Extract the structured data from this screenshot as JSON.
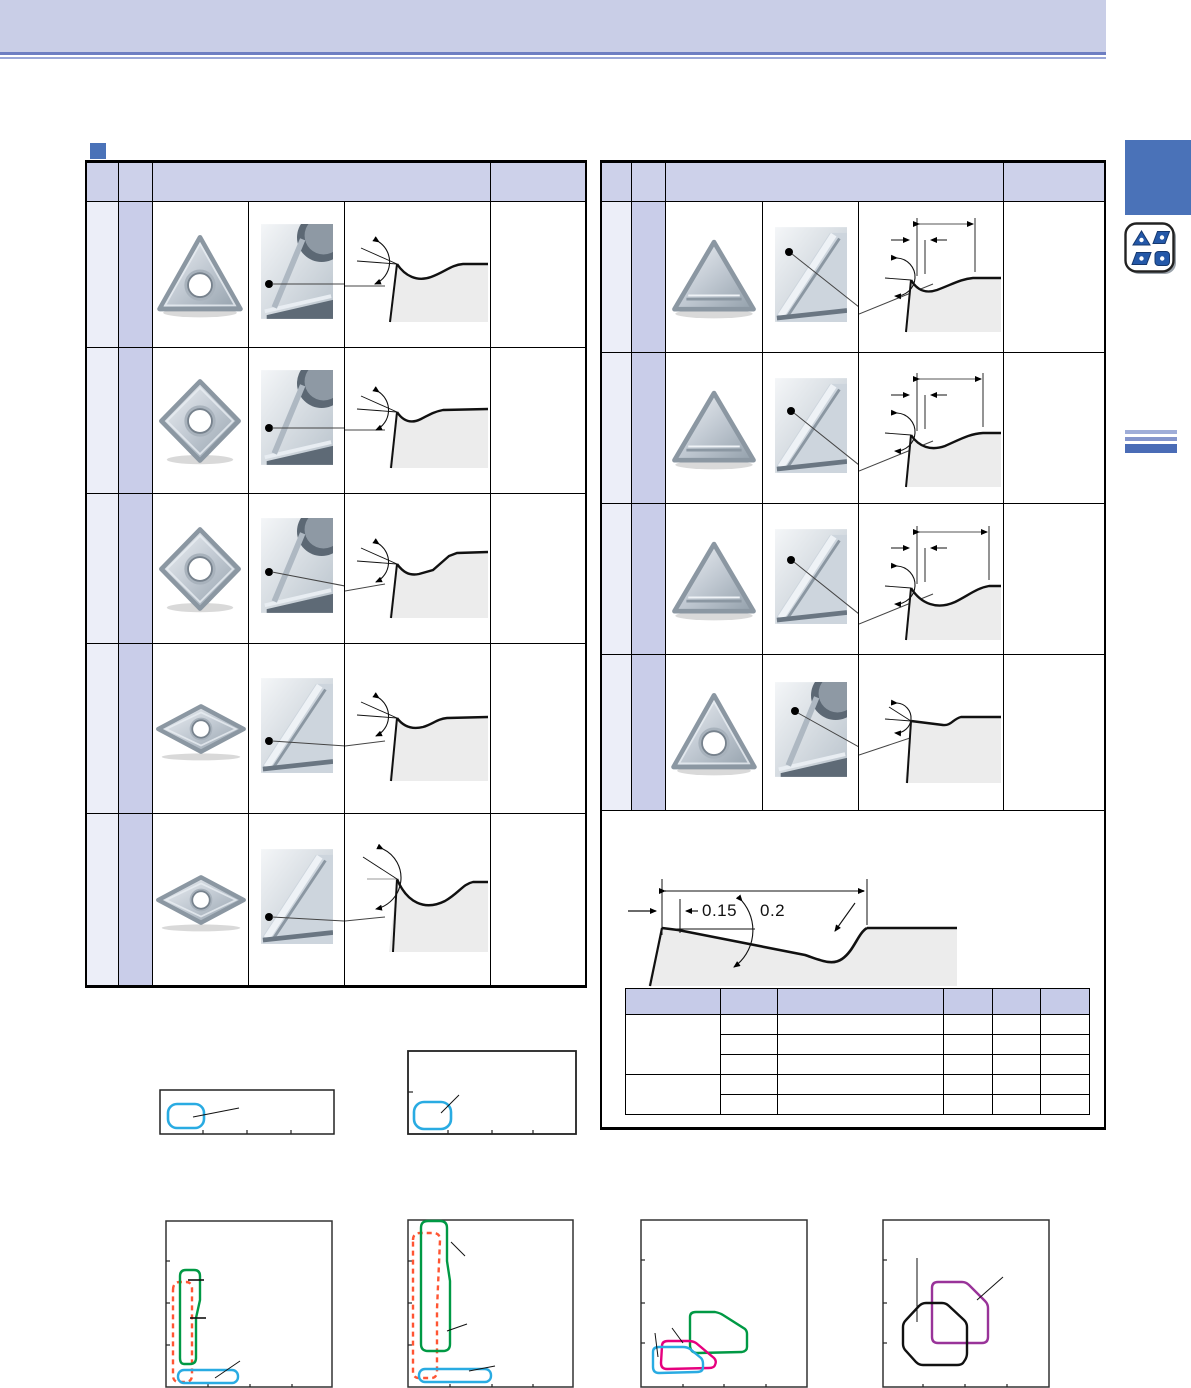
{
  "banner": {
    "bg": "#c9cee7",
    "underline_dark": "#6d7ec2",
    "underline_light": "#9aa7d8"
  },
  "section_marker": {
    "color": "#4a72b8"
  },
  "left_table": {
    "header_bg": "#cdd1ea",
    "narrow_col1_bg": "#eceef8",
    "narrow_col2_bg": "#c9cde9",
    "rows": [
      {
        "insert_icon": "triangle-insert-with-hole-icon",
        "closeup_icon": "corner-closeup-icon",
        "diagram_icon": "edge-cross-section-icon"
      },
      {
        "insert_icon": "diamond-insert-with-hole-icon",
        "closeup_icon": "corner-closeup-icon",
        "diagram_icon": "edge-cross-section-icon"
      },
      {
        "insert_icon": "diamond-insert-with-hole-icon",
        "closeup_icon": "corner-closeup-icon",
        "diagram_icon": "edge-cross-section-icon"
      },
      {
        "insert_icon": "diamond-55-insert-with-hole-icon",
        "closeup_icon": "corner-closeup-icon",
        "diagram_icon": "edge-cross-section-icon"
      },
      {
        "insert_icon": "diamond-55-insert-with-hole-icon",
        "closeup_icon": "corner-closeup-icon",
        "diagram_icon": "edge-cross-section-icon"
      }
    ]
  },
  "right_table": {
    "header_bg": "#cdd1ea",
    "rows": [
      {
        "insert_icon": "triangle-flat-insert-icon",
        "closeup_icon": "corner-closeup-icon",
        "diagram_icon": "edge-cross-section-dimensioned-icon"
      },
      {
        "insert_icon": "triangle-flat-insert-icon",
        "closeup_icon": "corner-closeup-icon",
        "diagram_icon": "edge-cross-section-dimensioned-icon"
      },
      {
        "insert_icon": "triangle-flat-insert-icon",
        "closeup_icon": "corner-closeup-icon",
        "diagram_icon": "edge-cross-section-dimensioned-icon"
      },
      {
        "insert_icon": "triangle-insert-with-hole-icon",
        "closeup_icon": "corner-closeup-icon",
        "diagram_icon": "edge-cross-section-flat-icon"
      }
    ]
  },
  "profile_diagram": {
    "dim_min": "0.15",
    "dim_max": "0.2"
  },
  "spec_table": {
    "header_bg": "#c6cbe8",
    "columns": 6,
    "row_groups": [
      3,
      2
    ]
  },
  "sidebar": {
    "tab_color": "#4a72b8",
    "icon_shapes": [
      "triangle",
      "parallelogram",
      "parallelogram",
      "square"
    ],
    "stripe_colors": [
      "#9fadd8",
      "#8495cc",
      "#4a6cb6"
    ]
  },
  "charts": {
    "small_top": [
      {
        "region_colors": [
          "#29abe2"
        ]
      },
      {
        "region_colors": [
          "#29abe2"
        ]
      }
    ],
    "large_bottom": [
      {
        "region_colors": [
          "#009944",
          "#ff5533",
          "#29abe2"
        ]
      },
      {
        "region_colors": [
          "#009944",
          "#ff5533",
          "#29abe2"
        ]
      },
      {
        "region_colors": [
          "#009944",
          "#e6007e",
          "#29abe2"
        ]
      },
      {
        "region_colors": [
          "#111111",
          "#993399"
        ]
      }
    ]
  }
}
